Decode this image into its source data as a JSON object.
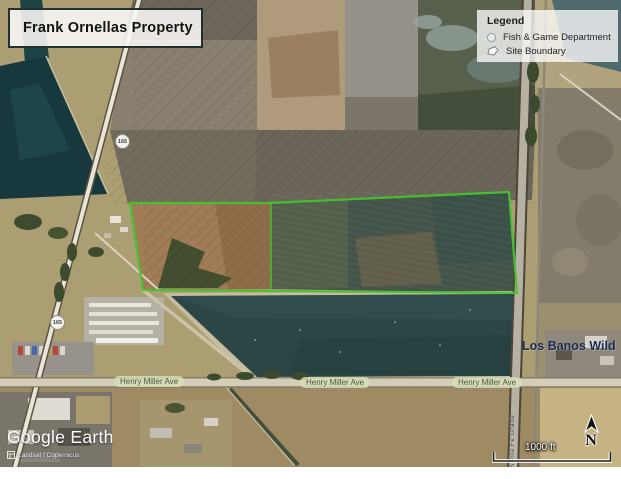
{
  "title_box": {
    "title": "Frank Ornellas Property"
  },
  "legend": {
    "title": "Legend",
    "items": [
      {
        "icon": "point-marker-icon",
        "label": "Fish & Game Department"
      },
      {
        "icon": "site-boundary-icon",
        "label": "Site Boundary"
      }
    ]
  },
  "map_labels": {
    "route_shields": [
      "165",
      "165"
    ],
    "henry_miller_ave": [
      "Henry Miller Ave",
      "Henry Miller Ave",
      "Henry Miller Ave"
    ],
    "area_label": "Los Banos Wild",
    "vertical_road_label": "Santa Fe Grade"
  },
  "scale_bar": {
    "distance": "1000 ft"
  },
  "compass": {
    "north_label": "N"
  },
  "branding": {
    "logo": "Google Earth",
    "attribution": "Landsat / Copernicus"
  },
  "colors": {
    "site_boundary_green": "#46c32e",
    "canal_water": "#17393d",
    "pond_water": "#2b4645",
    "area_label_navy": "#1a2a50",
    "road_label_bg": "#d5dfb6"
  }
}
